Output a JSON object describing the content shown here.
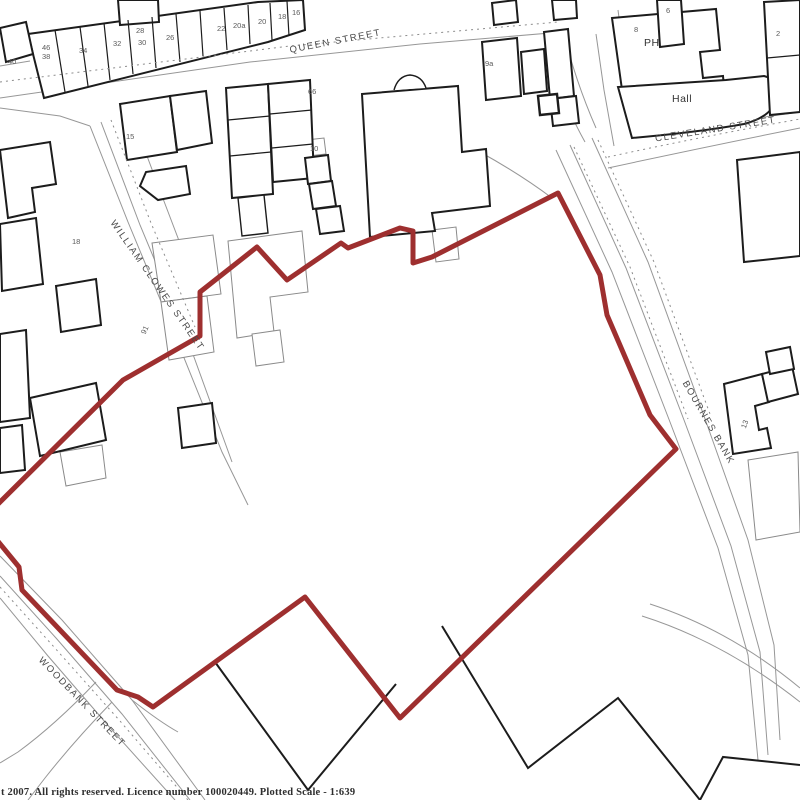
{
  "map": {
    "title": "Site location plan",
    "streets": [
      {
        "id": "queen-street",
        "label": "QUEEN STREET"
      },
      {
        "id": "cleveland-street",
        "label": "CLEVELAND STREET"
      },
      {
        "id": "william-clowes-street",
        "label": "WILLIAM CLOWES STREET"
      },
      {
        "id": "bournes-bank",
        "label": "BOURNES BANK"
      },
      {
        "id": "woodbank-street",
        "label": "WOODBANK STREET"
      }
    ],
    "places": [
      {
        "id": "public-house",
        "label": "PH"
      },
      {
        "id": "hall",
        "label": "Hall"
      }
    ],
    "house_numbers": [
      {
        "label": "40"
      },
      {
        "label": "46"
      },
      {
        "label": "38"
      },
      {
        "label": "34"
      },
      {
        "label": "32"
      },
      {
        "label": "28"
      },
      {
        "label": "30"
      },
      {
        "label": "26"
      },
      {
        "label": "22"
      },
      {
        "label": "20a"
      },
      {
        "label": "20"
      },
      {
        "label": "18"
      },
      {
        "label": "16"
      },
      {
        "label": "9a"
      },
      {
        "label": "15"
      },
      {
        "label": "66"
      },
      {
        "label": "10"
      },
      {
        "label": "91"
      },
      {
        "label": "18"
      },
      {
        "label": "13"
      },
      {
        "label": "2"
      },
      {
        "label": "6"
      },
      {
        "label": "8"
      }
    ],
    "footer": {
      "text": "t 2007.  All rights reserved.  Licence number 100020449.  Plotted Scale - 1:639"
    },
    "boundary_color": "#9e2f2f",
    "building_outline_color": "#1c1c1c",
    "road_line_color": "#979797"
  }
}
